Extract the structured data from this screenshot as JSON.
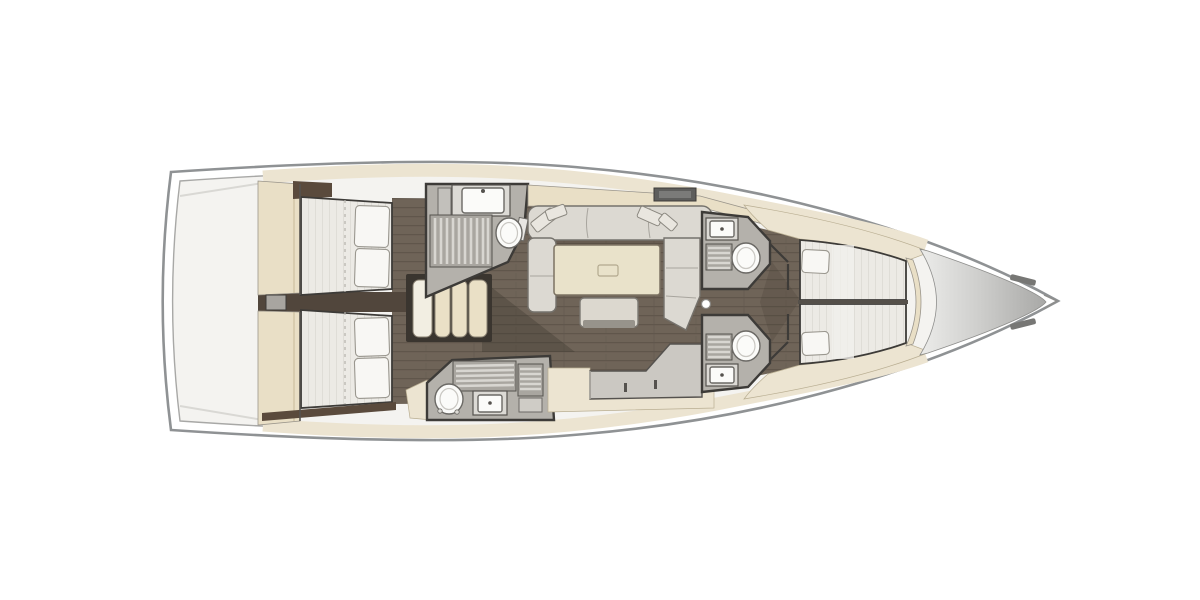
{
  "document": {
    "type": "yacht-interior-floor-plan",
    "view": "top-down",
    "orientation": {
      "bow": "right",
      "stern": "left"
    }
  },
  "palette": {
    "page_bg": "#ffffff",
    "hull_fill": "#ffffff",
    "hull_stroke": "#8f9294",
    "hull_inner_stroke": "#a8a8a6",
    "deck_fill": "#f4f3f0",
    "stern_line": "#d9d8d4",
    "cream": "#ece4d1",
    "cabinetry": "#e9dfc6",
    "walnut": "#5a4a3c",
    "plank_base": "#6f6458",
    "plank_line": "#60564b",
    "floor_dark": "#51463c",
    "mattress": "#eceae5",
    "mattress_line": "#dfddd7",
    "pillow": "#f8f7f4",
    "pillow_stroke": "#9a978f",
    "sofa": "#dcd9d2",
    "sofa_stroke": "#75726c",
    "table": "#e9e2ca",
    "table_stroke": "#7c7262",
    "bench": "#dcd8cf",
    "bath_floor": "#b4b1ab",
    "bath_wall": "#3d3b38",
    "fixture": "#fbfbf9",
    "fixture_stroke": "#6b6965",
    "counter": "#cbc8c2",
    "counter_stroke": "#55524e",
    "grate_slat": "#d8d6d1",
    "step": "#eae0c6",
    "step_stroke": "#8b8273",
    "hatch": "#5e5e5c",
    "bow_light": "#ececea",
    "bow_mid": "#cfcfcd",
    "bow_dark": "#a7a7a5"
  },
  "plan": {
    "rooms": [
      {
        "id": "stern-area",
        "name": "transom-stern-area",
        "fixtures": []
      },
      {
        "id": "aft-cabin-top",
        "name": "aft-double-cabin-port",
        "fixtures": [
          "double-berth",
          "two-pillows",
          "wardrobe"
        ]
      },
      {
        "id": "aft-cabin-bottom",
        "name": "aft-double-cabin-starboard",
        "fixtures": [
          "double-berth",
          "two-pillows",
          "wardrobe"
        ]
      },
      {
        "id": "companionway",
        "name": "companionway-stairs",
        "fixtures": [
          "four-steps"
        ]
      },
      {
        "id": "aft-head-top",
        "name": "aft-bathroom-port",
        "fixtures": [
          "sink",
          "shower-grate",
          "toilet"
        ]
      },
      {
        "id": "aft-head-bottom",
        "name": "aft-bathroom-starboard",
        "fixtures": [
          "toilet",
          "sink",
          "shower-grate"
        ]
      },
      {
        "id": "salon",
        "name": "main-salon",
        "fixtures": [
          "u-sofa",
          "throw-pillows",
          "dining-table",
          "ottoman-bench",
          "mast-post"
        ]
      },
      {
        "id": "counter-unit",
        "name": "galley-counter",
        "fixtures": [
          "l-shaped-counter",
          "drawer-handles"
        ]
      },
      {
        "id": "fwd-head-top",
        "name": "forward-bathroom-port",
        "fixtures": [
          "sink",
          "shower-grate",
          "toilet"
        ]
      },
      {
        "id": "fwd-head-bottom",
        "name": "forward-bathroom-starboard",
        "fixtures": [
          "sink",
          "shower-grate",
          "toilet"
        ]
      },
      {
        "id": "fwd-cabin",
        "name": "forward-owner-cabin",
        "fixtures": [
          "v-berth-port",
          "v-berth-starboard",
          "two-pillows"
        ]
      },
      {
        "id": "bow-locker",
        "name": "bow-anchor-locker",
        "fixtures": [
          "deck-cone",
          "cleats"
        ]
      }
    ]
  }
}
